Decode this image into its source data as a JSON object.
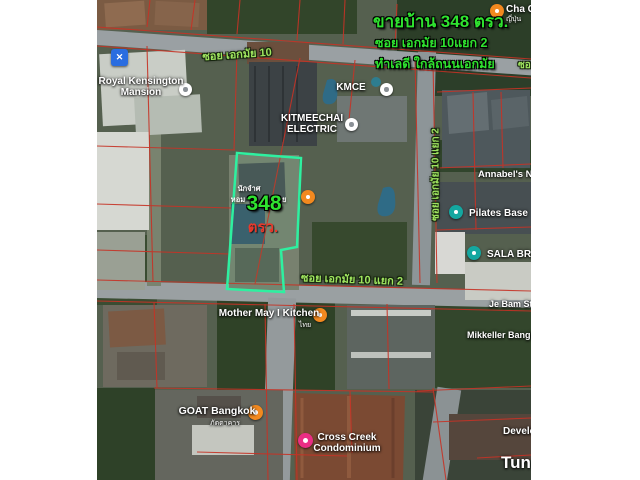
{
  "colors": {
    "headline_green": "#2fe22f",
    "street_green": "#9fe55f",
    "area_red": "#e8392b",
    "boundary_teal": "#2ef0a0",
    "food_orange": "#f2891f",
    "teal_poi": "#14a7a0",
    "lodging_pink": "#ea2e84",
    "hardware_blue": "#2a6de0",
    "poi_gray": "#8a9096",
    "cadastral_red": "#c63326"
  },
  "headline": {
    "title": "ขายบ้าน 348 ตรว.",
    "subtitle1": "ซอย เอกมัย 10แยก 2",
    "subtitle2": "ทำเลดี ใกล้ถนนเอกมัย"
  },
  "plot": {
    "note1": "นักจำศ",
    "note2": "หอม",
    "note3": "เกมย",
    "area_number": "348",
    "area_unit": "ตรว."
  },
  "streets": [
    {
      "name": "ซอย เอกมัย 10",
      "x": 140,
      "y": 45,
      "rot": -4,
      "size": 11,
      "center": true
    },
    {
      "name": "ซอย เอกมัย 10 แยก 2",
      "x": 255,
      "y": 270,
      "rot": 2,
      "size": 11,
      "center": true
    },
    {
      "name": "ซอย เอกมัย 10 แยก 2",
      "x": 339,
      "y": 167,
      "rot": -90,
      "size": 10,
      "center": true
    },
    {
      "name": "ซอย",
      "x": 421,
      "y": 58,
      "rot": 0,
      "size": 10,
      "center": false
    }
  ],
  "places": [
    {
      "id": "cha",
      "lines": [
        "Cha C"
      ],
      "sub": "ญี่ปุ่น",
      "x": 409,
      "y": 4,
      "size": 10,
      "center": false,
      "subx": 409,
      "suby": 16,
      "marker": {
        "icon": "restaurant-marker-icon",
        "color": "#f2891f",
        "x": 393,
        "y": 4,
        "d": 14,
        "shape": "circle"
      }
    },
    {
      "id": "royal-kensington",
      "lines": [
        "Royal Kensington",
        "Mansion"
      ],
      "x": 44,
      "y": 76,
      "size": 10,
      "center": true,
      "marker": {
        "icon": "lodging-marker-icon",
        "color": "#ffffff",
        "x": 82,
        "y": 83,
        "d": 13,
        "shape": "circle",
        "dot": "#8a9096"
      }
    },
    {
      "id": "kmce",
      "lines": [
        "KMCE"
      ],
      "x": 254,
      "y": 82,
      "size": 10,
      "center": true,
      "marker": {
        "icon": "poi-marker-icon",
        "color": "#ffffff",
        "x": 283,
        "y": 83,
        "d": 13,
        "shape": "circle",
        "dot": "#8a9096"
      }
    },
    {
      "id": "kitmeechai",
      "lines": [
        "KITMEECHAI",
        "ELECTRIC"
      ],
      "x": 215,
      "y": 113,
      "size": 10,
      "center": true,
      "marker": {
        "icon": "poi-marker-icon",
        "color": "#ffffff",
        "x": 248,
        "y": 118,
        "d": 13,
        "shape": "circle",
        "dot": "#8a9096"
      }
    },
    {
      "id": "plot-restaurant",
      "lines": [],
      "x": 0,
      "y": 0,
      "size": 0,
      "center": false,
      "marker": {
        "icon": "restaurant-marker-icon",
        "color": "#f2891f",
        "x": 204,
        "y": 190,
        "d": 14,
        "shape": "circle"
      }
    },
    {
      "id": "annabels",
      "lines": [
        "Annabel's Nu"
      ],
      "x": 381,
      "y": 170,
      "size": 9.5,
      "center": false
    },
    {
      "id": "pilates",
      "lines": [
        "Pilates Base"
      ],
      "x": 372,
      "y": 208,
      "size": 10,
      "center": false,
      "marker": {
        "icon": "fitness-marker-icon",
        "color": "#14a7a0",
        "x": 352,
        "y": 205,
        "d": 14,
        "shape": "circle"
      }
    },
    {
      "id": "sala",
      "lines": [
        "SALA BRAN"
      ],
      "x": 390,
      "y": 249,
      "size": 10,
      "center": false,
      "marker": {
        "icon": "store-marker-icon",
        "color": "#14a7a0",
        "x": 370,
        "y": 246,
        "d": 14,
        "shape": "circle"
      }
    },
    {
      "id": "je-bam",
      "lines": [
        "Je Bam Stu"
      ],
      "x": 392,
      "y": 299,
      "size": 9,
      "center": false
    },
    {
      "id": "mikkeller",
      "lines": [
        "Mikkeller Bangkok"
      ],
      "x": 370,
      "y": 330,
      "size": 9,
      "center": false
    },
    {
      "id": "mother-may",
      "lines": [
        "Mother May I Kitchen"
      ],
      "sub": "ไทย",
      "x": 172,
      "y": 308,
      "size": 10,
      "center": true,
      "subx": 208,
      "suby": 322,
      "marker": {
        "icon": "restaurant-marker-icon",
        "color": "#f2891f",
        "x": 216,
        "y": 308,
        "d": 14,
        "shape": "circle"
      }
    },
    {
      "id": "goat",
      "lines": [
        "GOAT Bangkok"
      ],
      "sub": "ภัตตาคาร",
      "x": 120,
      "y": 406,
      "size": 10.5,
      "center": true,
      "subx": 128,
      "suby": 420,
      "marker": {
        "icon": "restaurant-marker-icon",
        "color": "#f2891f",
        "x": 151,
        "y": 405,
        "d": 15,
        "shape": "circle"
      }
    },
    {
      "id": "cross-creek",
      "lines": [
        "Cross Creek",
        "Condominium"
      ],
      "x": 250,
      "y": 432,
      "size": 10,
      "center": true,
      "marker": {
        "icon": "hotel-marker-icon",
        "color": "#ea2e84",
        "x": 201,
        "y": 433,
        "d": 15,
        "shape": "circle"
      }
    },
    {
      "id": "development",
      "lines": [
        "Developme"
      ],
      "x": 406,
      "y": 426,
      "size": 10,
      "center": false
    },
    {
      "id": "tun",
      "lines": [
        "Tun"
      ],
      "x": 404,
      "y": 453,
      "size": 17,
      "center": false
    },
    {
      "id": "hardware",
      "lines": [],
      "x": 0,
      "y": 0,
      "size": 0,
      "center": false,
      "marker": {
        "icon": "hardware-store-icon",
        "color": "#2a6de0",
        "x": 14,
        "y": 49,
        "d": 17,
        "shape": "square",
        "glyph": "✕"
      }
    }
  ]
}
